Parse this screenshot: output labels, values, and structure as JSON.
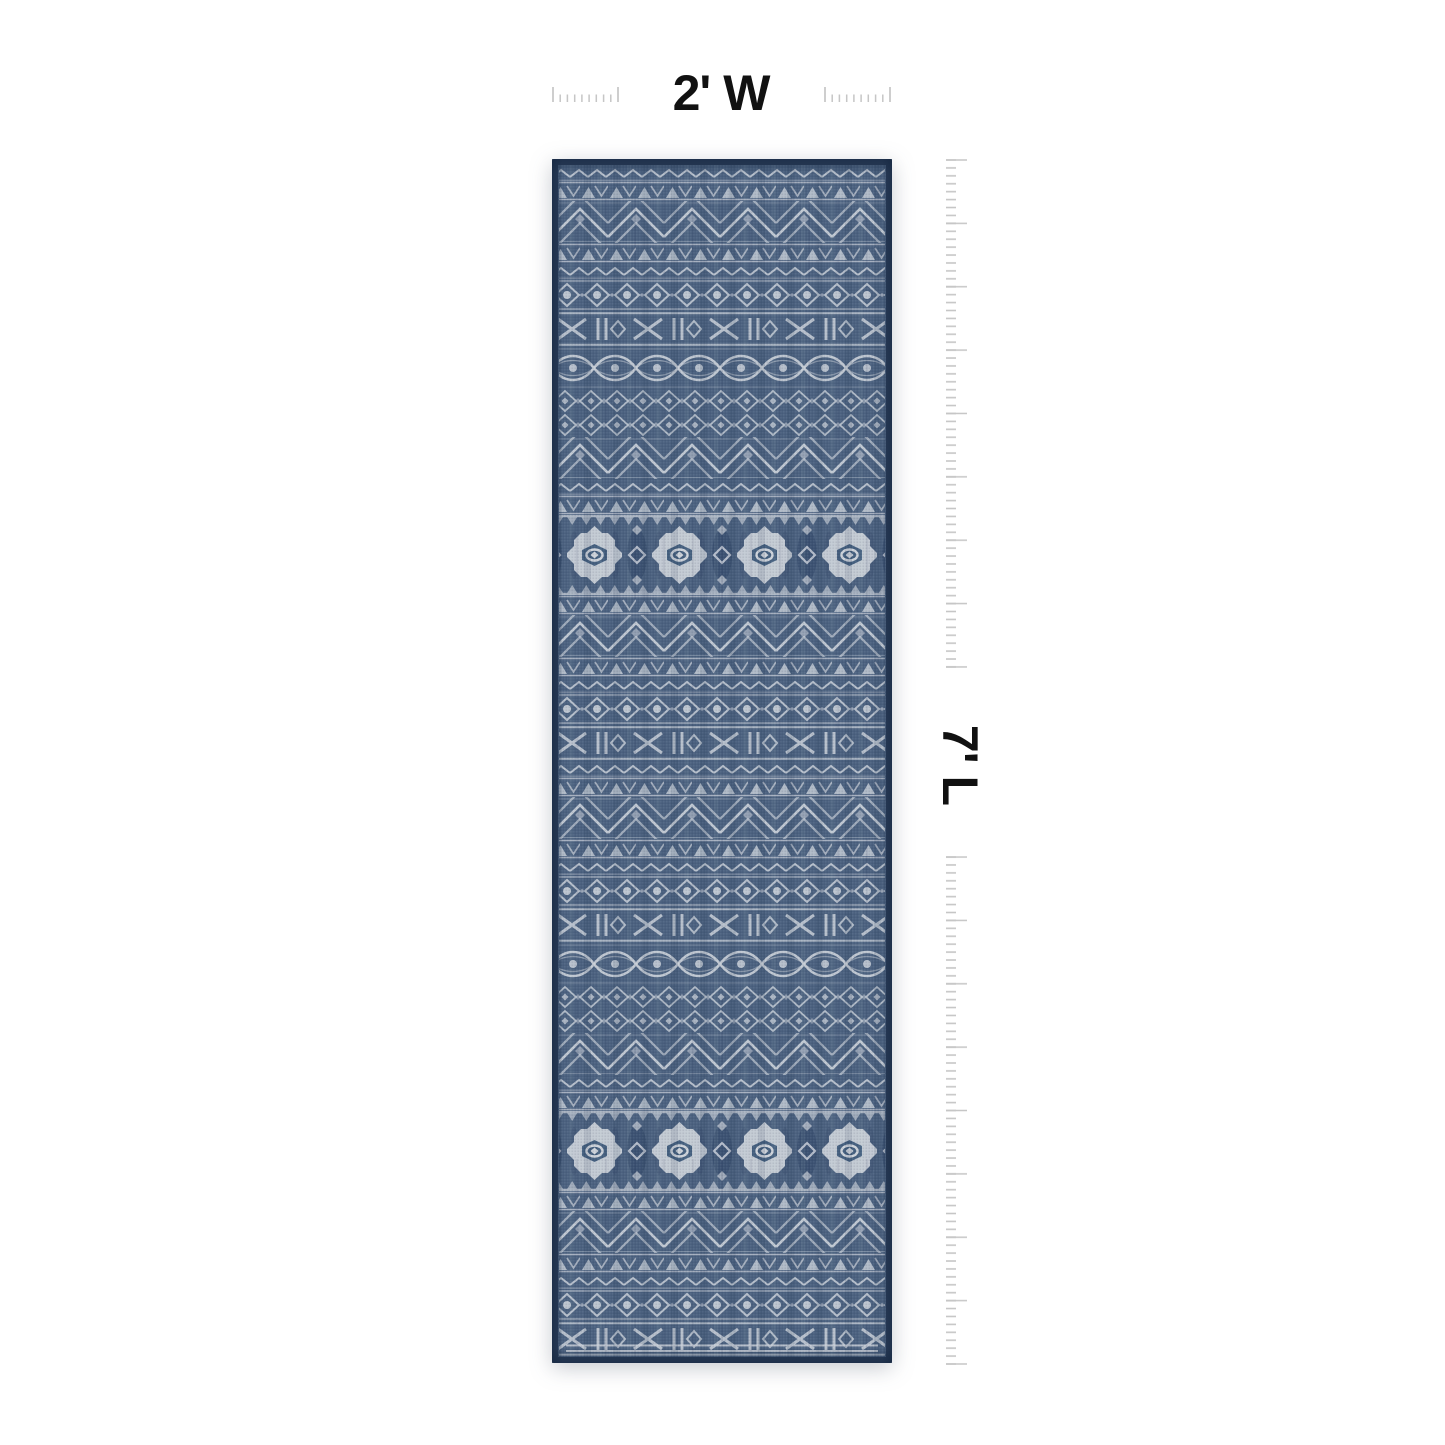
{
  "scene": {
    "type": "product-dimension-image",
    "background": "#ffffff",
    "description": "Top-down product shot of a navy blue runner rug with ivory tribal geometric banded pattern, annotated with width and length dimension rulers"
  },
  "product": {
    "name": "blue-aztec-runner-rug",
    "pattern_bands": [
      "zigzag",
      "triangles",
      "chevron",
      "diamond-eyes",
      "mudcloth-x-bars",
      "wave-eyes",
      "ogee-lattice",
      "aztec-medallions"
    ],
    "colors": {
      "edge_navy": "#2a3c58",
      "field_blue": "#4c6280",
      "pattern_ivory": "#c9cfd8"
    }
  },
  "dimensions": {
    "width_label": "2' W",
    "length_label": "7' L"
  },
  "annotation": {
    "tick_color": "#c6c6c6",
    "label_color": "#111111"
  }
}
